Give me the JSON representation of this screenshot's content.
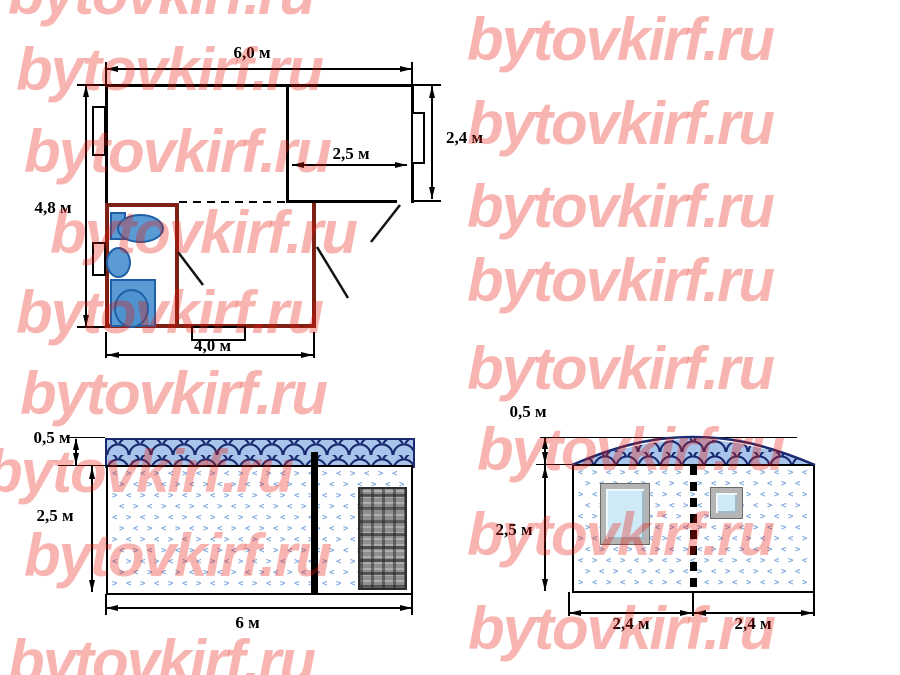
{
  "watermark": {
    "text": "bytovkirf.ru",
    "color": "rgba(232,28,15,0.33)",
    "rows": [
      {
        "x": 8,
        "y": -36
      },
      {
        "x": 16,
        "y": 40
      },
      {
        "x": 24,
        "y": 122
      },
      {
        "x": 50,
        "y": 203
      },
      {
        "x": 16,
        "y": 283
      },
      {
        "x": 20,
        "y": 364
      },
      {
        "x": -14,
        "y": 442
      },
      {
        "x": 24,
        "y": 526
      },
      {
        "x": 8,
        "y": 632
      },
      {
        "x": 467,
        "y": 10
      },
      {
        "x": 467,
        "y": 94
      },
      {
        "x": 467,
        "y": 177
      },
      {
        "x": 467,
        "y": 251
      },
      {
        "x": 467,
        "y": 339
      },
      {
        "x": 477,
        "y": 420
      },
      {
        "x": 467,
        "y": 505
      },
      {
        "x": 468,
        "y": 599
      }
    ]
  },
  "floor_plan": {
    "dim_width_total": "6,0 м",
    "dim_height_total": "4,8 м",
    "dim_room_width": "2,5 м",
    "dim_room_depth": "2,4 м",
    "dim_entrance_width": "4,0 м"
  },
  "front_elevation": {
    "dim_roof_height": "0,5 м",
    "dim_wall_height": "2,5 м",
    "dim_width": "6 м"
  },
  "side_elevation": {
    "dim_roof_height": "0,5 м",
    "dim_wall_height": "2,5 м",
    "dim_left_width": "2,4 м",
    "dim_right_width": "2,4 м"
  }
}
